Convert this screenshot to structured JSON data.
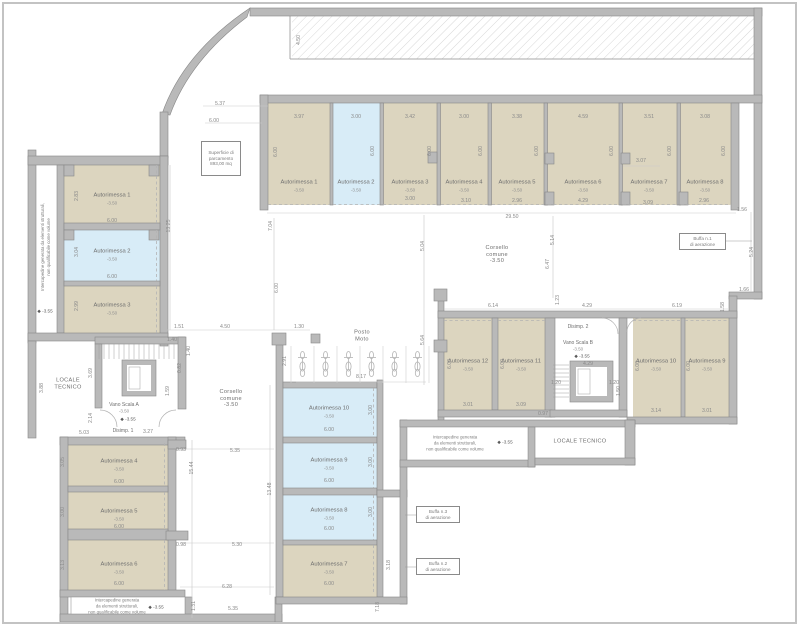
{
  "drawing": {
    "type": "architectural-floor-plan",
    "floor_level": "-3.50",
    "language": "it"
  },
  "colors": {
    "wall": "#b9b9b9",
    "wall_edge": "#878787",
    "room_beige": "#dcd5bf",
    "room_blue": "#d8ecf7",
    "dim_text": "#8a8a8a",
    "label_text": "#6e6e6e"
  },
  "callout_boxes": [
    {
      "s": "Superficie di\nparcamento\n893,00 mq",
      "x": 201,
      "y": 141,
      "w": 40,
      "h": 35,
      "n": "surface-area-note"
    },
    {
      "s": "Buffa n.1\ndi aerazione",
      "x": 679,
      "y": 233,
      "w": 47,
      "h": 17,
      "n": "vent-callout-1"
    },
    {
      "s": "Buffa n.3\ndi aerazione",
      "x": 416,
      "y": 506,
      "w": 44,
      "h": 17,
      "n": "vent-callout-3"
    },
    {
      "s": "Buffa n.2\ndi aerazione",
      "x": 416,
      "y": 558,
      "w": 44,
      "h": 17,
      "n": "vent-callout-2"
    }
  ],
  "labels": [
    {
      "s": "4.50",
      "x": 299,
      "y": 40,
      "r": -90
    },
    {
      "s": "5.37",
      "x": 220,
      "y": 104
    },
    {
      "s": "6.00",
      "x": 214,
      "y": 121
    },
    {
      "s": "1.51",
      "x": 179,
      "y": 327
    },
    {
      "s": "4.50",
      "x": 225,
      "y": 327
    },
    {
      "s": "1.30",
      "x": 299,
      "y": 327
    },
    {
      "s": "13.25",
      "x": 169,
      "y": 226,
      "r": -90
    },
    {
      "s": "7.04",
      "x": 271,
      "y": 226,
      "r": -90
    },
    {
      "s": "6.00",
      "x": 277,
      "y": 288,
      "r": -90
    },
    {
      "s": "2.91",
      "x": 285,
      "y": 361,
      "r": -90
    },
    {
      "s": "3.97",
      "x": 299,
      "y": 117
    },
    {
      "s": "3.00",
      "x": 356,
      "y": 117
    },
    {
      "s": "3.42",
      "x": 410,
      "y": 117
    },
    {
      "s": "3.00",
      "x": 464,
      "y": 117
    },
    {
      "s": "3.38",
      "x": 517,
      "y": 117
    },
    {
      "s": "4.59",
      "x": 583,
      "y": 117
    },
    {
      "s": "3.51",
      "x": 649,
      "y": 117
    },
    {
      "s": "3.08",
      "x": 705,
      "y": 117
    },
    {
      "s": "6.00",
      "x": 276,
      "y": 152,
      "r": -90
    },
    {
      "s": "6.00",
      "x": 373,
      "y": 151,
      "r": -90
    },
    {
      "s": "6.00",
      "x": 430,
      "y": 151,
      "r": -90
    },
    {
      "s": "6.00",
      "x": 481,
      "y": 151,
      "r": -90
    },
    {
      "s": "6.00",
      "x": 537,
      "y": 151,
      "r": -90
    },
    {
      "s": "6.00",
      "x": 612,
      "y": 151,
      "r": -90
    },
    {
      "s": "6.00",
      "x": 670,
      "y": 151,
      "r": -90
    },
    {
      "s": "6.00",
      "x": 724,
      "y": 151,
      "r": -90
    },
    {
      "s": "Autorimessa 1",
      "x": 299,
      "y": 183,
      "c": "room",
      "n": "room-label-autorimessa-1-top"
    },
    {
      "s": "-3.50",
      "x": 299,
      "y": 190,
      "c": "lvl",
      "n": "room-level"
    },
    {
      "s": "Autorimessa 2",
      "x": 356,
      "y": 183,
      "c": "room",
      "n": "room-label-autorimessa-2-top"
    },
    {
      "s": "-3.50",
      "x": 356,
      "y": 190,
      "c": "lvl",
      "n": "room-level"
    },
    {
      "s": "Autorimessa 3",
      "x": 410,
      "y": 183,
      "c": "room",
      "n": "room-label-autorimessa-3-top"
    },
    {
      "s": "-3.50",
      "x": 410,
      "y": 190,
      "c": "lvl",
      "n": "room-level"
    },
    {
      "s": "Autorimessa 4",
      "x": 464,
      "y": 183,
      "c": "room",
      "n": "room-label-autorimessa-4-top"
    },
    {
      "s": "-3.50",
      "x": 464,
      "y": 190,
      "c": "lvl",
      "n": "room-level"
    },
    {
      "s": "Autorimessa 5",
      "x": 517,
      "y": 183,
      "c": "room",
      "n": "room-label-autorimessa-5-top"
    },
    {
      "s": "-3.50",
      "x": 517,
      "y": 190,
      "c": "lvl",
      "n": "room-level"
    },
    {
      "s": "Autorimessa 6",
      "x": 583,
      "y": 183,
      "c": "room",
      "n": "room-label-autorimessa-6-top"
    },
    {
      "s": "-3.50",
      "x": 583,
      "y": 190,
      "c": "lvl",
      "n": "room-level"
    },
    {
      "s": "Autorimessa 7",
      "x": 649,
      "y": 183,
      "c": "room",
      "n": "room-label-autorimessa-7-top"
    },
    {
      "s": "-3.50",
      "x": 649,
      "y": 190,
      "c": "lvl",
      "n": "room-level"
    },
    {
      "s": "Autorimessa 8",
      "x": 705,
      "y": 183,
      "c": "room",
      "n": "room-label-autorimessa-8-top"
    },
    {
      "s": "-3.50",
      "x": 705,
      "y": 190,
      "c": "lvl",
      "n": "room-level"
    },
    {
      "s": "3.00",
      "x": 410,
      "y": 199
    },
    {
      "s": "3.10",
      "x": 466,
      "y": 201
    },
    {
      "s": "2.96",
      "x": 517,
      "y": 201
    },
    {
      "s": "4.29",
      "x": 583,
      "y": 201
    },
    {
      "s": "3.07",
      "x": 641,
      "y": 161
    },
    {
      "s": "3.09",
      "x": 648,
      "y": 203
    },
    {
      "s": "2.96",
      "x": 704,
      "y": 201
    },
    {
      "s": "29.50",
      "x": 512,
      "y": 217
    },
    {
      "s": "1.56",
      "x": 742,
      "y": 210
    },
    {
      "s": "5.24",
      "x": 752,
      "y": 252,
      "r": -90
    },
    {
      "s": "1.66",
      "x": 744,
      "y": 290
    },
    {
      "s": "Autorimessa 1",
      "x": 112,
      "y": 196,
      "c": "room",
      "n": "room-label-autorimessa-1-left"
    },
    {
      "s": "-3.50",
      "x": 112,
      "y": 203,
      "c": "lvl",
      "n": "room-level"
    },
    {
      "s": "2.83",
      "x": 77,
      "y": 196,
      "r": -90
    },
    {
      "s": "6.00",
      "x": 112,
      "y": 221
    },
    {
      "s": "Autorimessa 2",
      "x": 112,
      "y": 252,
      "c": "room",
      "n": "room-label-autorimessa-2-left"
    },
    {
      "s": "-3.50",
      "x": 112,
      "y": 259,
      "c": "lvl",
      "n": "room-level"
    },
    {
      "s": "3.04",
      "x": 77,
      "y": 252,
      "r": -90
    },
    {
      "s": "6.00",
      "x": 112,
      "y": 277
    },
    {
      "s": "Autorimessa 3",
      "x": 112,
      "y": 306,
      "c": "room",
      "n": "room-label-autorimessa-3-left"
    },
    {
      "s": "-3.50",
      "x": 112,
      "y": 313,
      "c": "lvl",
      "n": "room-level"
    },
    {
      "s": "2.99",
      "x": 77,
      "y": 306,
      "r": -90
    },
    {
      "s": "Intercapedine generata da elementi strutturali,\nnon qualificabile come volume",
      "x": 46,
      "y": 247,
      "r": -90,
      "c": "note",
      "n": "intercapedine-note-left"
    },
    {
      "s": "◆ -3.55",
      "x": 45,
      "y": 311,
      "c": "quota",
      "n": "elevation-marker"
    },
    {
      "s": "LOCALE\nTECNICO",
      "x": 68,
      "y": 384,
      "c": "area",
      "n": "locale-tecnico-left-label"
    },
    {
      "s": "3.88",
      "x": 42,
      "y": 388,
      "r": -90
    },
    {
      "s": "3.69",
      "x": 91,
      "y": 373,
      "r": -90
    },
    {
      "s": "2.14",
      "x": 91,
      "y": 418,
      "r": -90
    },
    {
      "s": "5.03",
      "x": 84,
      "y": 433
    },
    {
      "s": "1.40",
      "x": 172,
      "y": 340
    },
    {
      "s": "1.40",
      "x": 189,
      "y": 351,
      "r": -90
    },
    {
      "s": "0.82",
      "x": 180,
      "y": 368,
      "r": -90
    },
    {
      "s": "1.59",
      "x": 168,
      "y": 391,
      "r": -90
    },
    {
      "s": "Vano Scala A",
      "x": 124,
      "y": 405,
      "c": "area2",
      "n": "vano-scala-a-label"
    },
    {
      "s": "-3.50",
      "x": 124,
      "y": 411,
      "c": "lvl",
      "n": "room-level"
    },
    {
      "s": "◆ -3.55",
      "x": 128,
      "y": 419,
      "c": "quota",
      "n": "elevation-marker"
    },
    {
      "s": "Disimp. 1",
      "x": 123,
      "y": 431,
      "c": "area2",
      "n": "disimpegno-1-label"
    },
    {
      "s": "3.27",
      "x": 148,
      "y": 432
    },
    {
      "s": "0.93",
      "x": 181,
      "y": 450
    },
    {
      "s": "Autorimessa 4",
      "x": 119,
      "y": 462,
      "c": "room",
      "n": "room-label-autorimessa-4-left"
    },
    {
      "s": "-3.50",
      "x": 119,
      "y": 469,
      "c": "lvl",
      "n": "room-level"
    },
    {
      "s": "3.05",
      "x": 63,
      "y": 462,
      "r": -90
    },
    {
      "s": "6.00",
      "x": 119,
      "y": 482
    },
    {
      "s": "Autorimessa 5",
      "x": 119,
      "y": 512,
      "c": "room",
      "n": "room-label-autorimessa-5-left"
    },
    {
      "s": "-3.50",
      "x": 119,
      "y": 519,
      "c": "lvl",
      "n": "room-level"
    },
    {
      "s": "3.00",
      "x": 63,
      "y": 512,
      "r": -90
    },
    {
      "s": "6.00",
      "x": 119,
      "y": 527
    },
    {
      "s": "Autorimessa 6",
      "x": 119,
      "y": 565,
      "c": "room",
      "n": "room-label-autorimessa-6-left"
    },
    {
      "s": "-3.50",
      "x": 119,
      "y": 572,
      "c": "lvl",
      "n": "room-level"
    },
    {
      "s": "3.13",
      "x": 63,
      "y": 565,
      "r": -90
    },
    {
      "s": "6.00",
      "x": 119,
      "y": 584
    },
    {
      "s": "15.44",
      "x": 192,
      "y": 468,
      "r": -90
    },
    {
      "s": "13.48",
      "x": 270,
      "y": 489,
      "r": -90
    },
    {
      "s": "5.35",
      "x": 235,
      "y": 451
    },
    {
      "s": "0.98",
      "x": 181,
      "y": 545
    },
    {
      "s": "5.30",
      "x": 237,
      "y": 545
    },
    {
      "s": "6.28",
      "x": 227,
      "y": 587
    },
    {
      "s": "1.31",
      "x": 194,
      "y": 606,
      "r": -90
    },
    {
      "s": "5.35",
      "x": 233,
      "y": 609
    },
    {
      "s": "7.18",
      "x": 378,
      "y": 607,
      "r": -90
    },
    {
      "s": "Intercapedine generata\nda elementi strutturali,\nnon qualificabile come volume",
      "x": 117,
      "y": 606,
      "c": "note",
      "n": "intercapedine-note-bottom"
    },
    {
      "s": "◆ -3.55",
      "x": 156,
      "y": 607,
      "c": "quota",
      "n": "elevation-marker"
    },
    {
      "s": "Autorimessa 10",
      "x": 329,
      "y": 409,
      "c": "room",
      "n": "room-label-autorimessa-10-center"
    },
    {
      "s": "-3.50",
      "x": 329,
      "y": 416,
      "c": "lvl",
      "n": "room-level"
    },
    {
      "s": "3.00",
      "x": 371,
      "y": 410,
      "r": -90
    },
    {
      "s": "6.00",
      "x": 329,
      "y": 430
    },
    {
      "s": "Autorimessa 9",
      "x": 329,
      "y": 461,
      "c": "room",
      "n": "room-label-autorimessa-9-center"
    },
    {
      "s": "-3.50",
      "x": 329,
      "y": 468,
      "c": "lvl",
      "n": "room-level"
    },
    {
      "s": "3.00",
      "x": 371,
      "y": 462,
      "r": -90
    },
    {
      "s": "6.00",
      "x": 329,
      "y": 481
    },
    {
      "s": "Autorimessa 8",
      "x": 329,
      "y": 511,
      "c": "room",
      "n": "room-label-autorimessa-8-center"
    },
    {
      "s": "-3.50",
      "x": 329,
      "y": 518,
      "c": "lvl",
      "n": "room-level"
    },
    {
      "s": "3.00",
      "x": 371,
      "y": 512,
      "r": -90
    },
    {
      "s": "6.00",
      "x": 329,
      "y": 529
    },
    {
      "s": "Autorimessa 7",
      "x": 329,
      "y": 565,
      "c": "room",
      "n": "room-label-autorimessa-7-center"
    },
    {
      "s": "-3.50",
      "x": 329,
      "y": 572,
      "c": "lvl",
      "n": "room-level"
    },
    {
      "s": "3.18",
      "x": 389,
      "y": 565,
      "r": -90
    },
    {
      "s": "6.00",
      "x": 329,
      "y": 584
    },
    {
      "s": "Corsello\ncomune\n-3.50",
      "x": 497,
      "y": 255,
      "c": "area",
      "n": "corsello-comune-label-1"
    },
    {
      "s": "Corsello\ncomune\n-3.50",
      "x": 231,
      "y": 399,
      "c": "area",
      "n": "corsello-comune-label-2"
    },
    {
      "s": "Posto\nMoto",
      "x": 362,
      "y": 336,
      "c": "area",
      "n": "posto-moto-label"
    },
    {
      "s": "8.17",
      "x": 361,
      "y": 377
    },
    {
      "s": "5.04",
      "x": 423,
      "y": 246,
      "r": -90
    },
    {
      "s": "5.64",
      "x": 423,
      "y": 340,
      "r": -90
    },
    {
      "s": "5.14",
      "x": 553,
      "y": 240,
      "r": -90
    },
    {
      "s": "6.47",
      "x": 548,
      "y": 264,
      "r": -90
    },
    {
      "s": "6.14",
      "x": 493,
      "y": 306
    },
    {
      "s": "4.29",
      "x": 587,
      "y": 306
    },
    {
      "s": "6.19",
      "x": 677,
      "y": 306
    },
    {
      "s": "1.23",
      "x": 558,
      "y": 300,
      "r": -90
    },
    {
      "s": "1.58",
      "x": 723,
      "y": 307,
      "r": -90
    },
    {
      "s": "Autorimessa 12",
      "x": 468,
      "y": 362,
      "c": "room",
      "n": "room-label-autorimessa-12-right"
    },
    {
      "s": "-3.50",
      "x": 468,
      "y": 369,
      "c": "lvl",
      "n": "room-level"
    },
    {
      "s": "6.00",
      "x": 450,
      "y": 364,
      "r": -90
    },
    {
      "s": "3.01",
      "x": 468,
      "y": 405
    },
    {
      "s": "Autorimessa 11",
      "x": 521,
      "y": 362,
      "c": "room",
      "n": "room-label-autorimessa-11-right"
    },
    {
      "s": "-3.50",
      "x": 521,
      "y": 369,
      "c": "lvl",
      "n": "room-level"
    },
    {
      "s": "6.00",
      "x": 503,
      "y": 364,
      "r": -90
    },
    {
      "s": "3.09",
      "x": 521,
      "y": 405
    },
    {
      "s": "Autorimessa 10",
      "x": 656,
      "y": 362,
      "c": "room",
      "n": "room-label-autorimessa-10-right"
    },
    {
      "s": "-3.50",
      "x": 656,
      "y": 369,
      "c": "lvl",
      "n": "room-level"
    },
    {
      "s": "6.00",
      "x": 638,
      "y": 366,
      "r": -90
    },
    {
      "s": "3.14",
      "x": 656,
      "y": 411
    },
    {
      "s": "Autorimessa 9",
      "x": 707,
      "y": 362,
      "c": "room",
      "n": "room-label-autorimessa-9-right"
    },
    {
      "s": "-3.50",
      "x": 707,
      "y": 369,
      "c": "lvl",
      "n": "room-level"
    },
    {
      "s": "6.00",
      "x": 689,
      "y": 366,
      "r": -90
    },
    {
      "s": "3.01",
      "x": 707,
      "y": 411
    },
    {
      "s": "0.97",
      "x": 543,
      "y": 414
    },
    {
      "s": "Disimp. 2",
      "x": 578,
      "y": 327,
      "c": "area2",
      "n": "disimpegno-2-label"
    },
    {
      "s": "Vano Scala B",
      "x": 578,
      "y": 343,
      "c": "area2",
      "n": "vano-scala-b-label"
    },
    {
      "s": "-3.50",
      "x": 578,
      "y": 349,
      "c": "lvl",
      "n": "room-level"
    },
    {
      "s": "◆ -3.55",
      "x": 582,
      "y": 356,
      "c": "quota",
      "n": "elevation-marker"
    },
    {
      "s": "4.29",
      "x": 588,
      "y": 364
    },
    {
      "s": "1.20",
      "x": 556,
      "y": 383
    },
    {
      "s": "1.20",
      "x": 614,
      "y": 383
    },
    {
      "s": "1.50",
      "x": 619,
      "y": 391,
      "r": -90
    },
    {
      "s": "LOCALE TECNICO",
      "x": 580,
      "y": 442,
      "c": "area",
      "n": "locale-tecnico-right-label"
    },
    {
      "s": "Intercapedine generata\nda elementi strutturali,\nnon qualificabile come volume",
      "x": 455,
      "y": 443,
      "c": "note",
      "n": "intercapedine-note-center"
    },
    {
      "s": "◆ -3.55",
      "x": 505,
      "y": 442,
      "c": "quota",
      "n": "elevation-marker"
    }
  ]
}
